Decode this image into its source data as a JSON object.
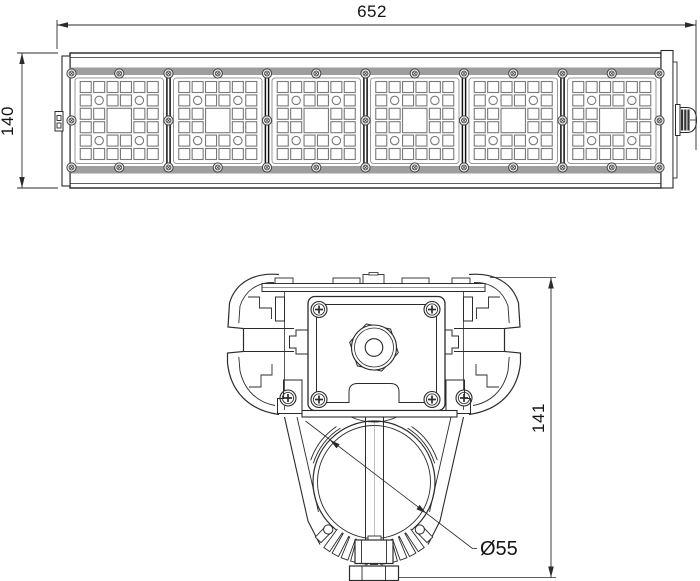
{
  "front_view": {
    "dim_length": "652",
    "dim_height": "140",
    "module_count": 6
  },
  "section_view": {
    "dim_height": "141",
    "dim_diameter": "Ø55"
  },
  "colors": {
    "line": "#2b2b2b",
    "line_dark": "#141414",
    "line_light": "#8c8c8c",
    "bar_gray": "#9e9e9e",
    "led_stroke": "#7a7a7a",
    "background": "#ffffff"
  }
}
